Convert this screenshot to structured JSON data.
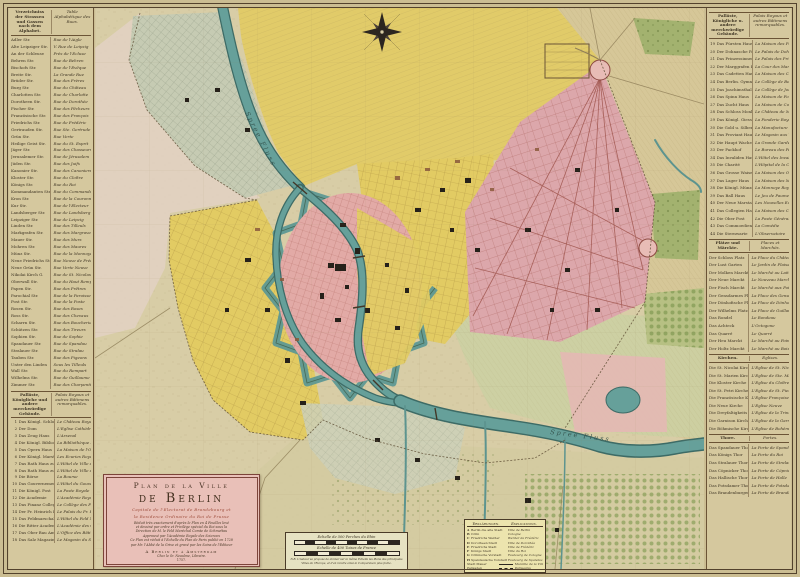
{
  "palette": {
    "paper-edge": "#cbbd92",
    "legend-bg": "#d5c89e",
    "map-bg": "#d8cda6",
    "ink": "#3f3524",
    "river": "#66a09a",
    "river-edge": "#3d6b66",
    "pink-core": "#e2aaa6",
    "pink-grid": "#dca7ab",
    "yellow-district": "#e2cb63",
    "gray-green": "#c6cbb3",
    "pale-green": "#cbd0a2",
    "wood-green": "#a3b26f",
    "cartouche-pink": "#e9c0b8",
    "box-cream": "#e6e2c2",
    "box-yellow": "#ece4ae",
    "street-red": "#9c5048"
  },
  "cartouche": {
    "line1": "Plan de la Ville",
    "line2": "de Berlin",
    "sub1": "Capitale de l'Electorat de Brandebourg et",
    "sub2": "la Residence Ordinaire du Roi de Prusse",
    "body": [
      "Réduit très exactement d'après le Plan en 4 Feuilles levé",
      "et dessiné par ordre et Privilège spécial du Roi sous la",
      "Direction de M. le Feld Maréchal Comte de Schmettau",
      "Approuvé par l'Académie Royale des Sciences",
      "Ce Plan est réduit à l'Echelle du Plan de Paris publié en 1728",
      "par Mr. l'Abbé de la Grive et gravé par les Soins de l'Editeur"
    ],
    "imprint1": "A Berlin et à Amsterdam",
    "imprint2": "Chez le Sr. Neaulme, Libraire.",
    "year": "1757."
  },
  "scalebox": {
    "scale1_label": "Echelle de 500 Perches du Rhin",
    "scale2_label": "Echelle de 400 Toises de France",
    "note": "N.B. L'Auteur se propose de donner sur la même Echelle les Plans des principales Villes de l'Europe, et d'en rendre ainsi la Comparaison plus facile."
  },
  "explanations": {
    "header_de": "Erklärungen.",
    "header_fr": "Explications.",
    "entries": [
      {
        "key": "A",
        "de": "Berlin die alte Stadt",
        "fr": "Ville de Berlin"
      },
      {
        "key": "B",
        "de": "Cölln",
        "fr": "Cologne"
      },
      {
        "key": "C",
        "de": "Friedrichs Werder",
        "fr": "Werder de Frédéric"
      },
      {
        "key": "D",
        "de": "Dorotheen Stadt",
        "fr": "Ville de Dorothée"
      },
      {
        "key": "E",
        "de": "Friedrichs Stadt",
        "fr": "Ville de Frédéric"
      },
      {
        "key": "F",
        "de": "Königs Stadt",
        "fr": "Ville du Roi"
      },
      {
        "key": "G",
        "de": "Cöllnische Vorstadt",
        "fr": "Faubourg de Cologne"
      },
      {
        "key": "H",
        "de": "Spandauische Vorstadt",
        "fr": "Faubourg de Spandau"
      }
    ],
    "samples": [
      {
        "de": "Stadt Mauer",
        "fr": "Muraille de la Ville",
        "style": "solid"
      },
      {
        "de": "Palisaden",
        "fr": "Palissades",
        "style": "dashed"
      }
    ]
  },
  "left_legend": {
    "title_de": "Verzeichniss der Strassen und Gassen nach dem Alphabet.",
    "title_fr": "Table Alphabétique des Rues.",
    "streets": [
      {
        "de": "Adler Str.",
        "fr": "Rue de l'Aigle"
      },
      {
        "de": "Alte Leipziger Str.",
        "fr": "V. Rue de Leipzig"
      },
      {
        "de": "An der Schleuse",
        "fr": "Près de l'Ecluse"
      },
      {
        "de": "Behren Str.",
        "fr": "Rue de Behren"
      },
      {
        "de": "Bischofs Str.",
        "fr": "Rue de l'Evêque"
      },
      {
        "de": "Breite Str.",
        "fr": "La Grande Rue"
      },
      {
        "de": "Brüder Str.",
        "fr": "Rue des Frères"
      },
      {
        "de": "Burg Str.",
        "fr": "Rue du Château"
      },
      {
        "de": "Charlotten Str.",
        "fr": "Rue de Charlotte"
      },
      {
        "de": "Dorotheen Str.",
        "fr": "Rue de Dorothée"
      },
      {
        "de": "Fischer Str.",
        "fr": "Rue des Pêcheurs"
      },
      {
        "de": "Französische Str.",
        "fr": "Rue des François"
      },
      {
        "de": "Friedrichs Str.",
        "fr": "Rue de Frédéric"
      },
      {
        "de": "Gertrauden Str.",
        "fr": "Rue Ste. Gertrude"
      },
      {
        "de": "Grün Str.",
        "fr": "Rue Verte"
      },
      {
        "de": "Heilige Geist Str.",
        "fr": "Rue du St. Esprit"
      },
      {
        "de": "Jäger Str.",
        "fr": "Rue des Chasseurs"
      },
      {
        "de": "Jerusalemer Str.",
        "fr": "Rue de Jérusalem"
      },
      {
        "de": "Jüden Str.",
        "fr": "Rue des Juifs"
      },
      {
        "de": "Kanonier Str.",
        "fr": "Rue des Canoniers"
      },
      {
        "de": "Kloster Str.",
        "fr": "Rue du Cloître"
      },
      {
        "de": "Königs Str.",
        "fr": "Rue du Roi"
      },
      {
        "de": "Kommandanten Str.",
        "fr": "Rue du Commandant"
      },
      {
        "de": "Kron Str.",
        "fr": "Rue de la Couronne"
      },
      {
        "de": "Kur Str.",
        "fr": "Rue de l'Electeur"
      },
      {
        "de": "Landsberger Str.",
        "fr": "Rue de Landsberg"
      },
      {
        "de": "Leipziger Str.",
        "fr": "Rue de Leipzig"
      },
      {
        "de": "Linden Str.",
        "fr": "Rue des Tilleuls"
      },
      {
        "de": "Markgrafen Str.",
        "fr": "Rue des Margraves"
      },
      {
        "de": "Mauer Str.",
        "fr": "Rue des Murs"
      },
      {
        "de": "Mohren Str.",
        "fr": "Rue des Maures"
      },
      {
        "de": "Münz Str.",
        "fr": "Rue de la Monnoye"
      },
      {
        "de": "Neue Friedrichs Str.",
        "fr": "Rue Neuve de Frédéric"
      },
      {
        "de": "Neue Grün Str.",
        "fr": "Rue Verte Neuve"
      },
      {
        "de": "Nikolai Kirch G.",
        "fr": "Rue de St. Nicolas"
      },
      {
        "de": "Oberwall Str.",
        "fr": "Rue du Haut Rempart"
      },
      {
        "de": "Papen Str.",
        "fr": "Rue des Prêtres"
      },
      {
        "de": "Parochial Str.",
        "fr": "Rue de la Paroisse"
      },
      {
        "de": "Post Str.",
        "fr": "Rue de la Poste"
      },
      {
        "de": "Rosen Str.",
        "fr": "Rue des Roses"
      },
      {
        "de": "Ross Str.",
        "fr": "Rue des Chevaux"
      },
      {
        "de": "Scharrn Str.",
        "fr": "Rue des Boucheries"
      },
      {
        "de": "Schützen Str.",
        "fr": "Rue des Tireurs"
      },
      {
        "de": "Sophien Str.",
        "fr": "Rue de Sophie"
      },
      {
        "de": "Spandauer Str.",
        "fr": "Rue de Spandau"
      },
      {
        "de": "Stralauer Str.",
        "fr": "Rue de Stralau"
      },
      {
        "de": "Tauben Str.",
        "fr": "Rue des Pigeons"
      },
      {
        "de": "Unter den Linden",
        "fr": "Sous les Tilleuls"
      },
      {
        "de": "Wall Str.",
        "fr": "Rue du Rempart"
      },
      {
        "de": "Wilhelms Str.",
        "fr": "Rue de Guillaume"
      },
      {
        "de": "Zimmer Str.",
        "fr": "Rue des Charpentiers"
      }
    ],
    "buildings": {
      "title_de": "Palläste, Königliche und andere merckwürdige Gebäude.",
      "title_fr": "Palais Royaux et autres Bâtimens remarquables.",
      "entries": [
        {
          "n": "1",
          "de": "Das Königl. Schloss",
          "fr": "Le Château Royal"
        },
        {
          "n": "2",
          "de": "Der Dom",
          "fr": "L'Eglise Cathédrale"
        },
        {
          "n": "3",
          "de": "Das Zeug Haus",
          "fr": "L'Arsenal"
        },
        {
          "n": "4",
          "de": "Die Königl. Bibliothek",
          "fr": "La Bibliothèque Royale"
        },
        {
          "n": "5",
          "de": "Das Opern Haus",
          "fr": "La Maison de l'Opéra"
        },
        {
          "n": "6",
          "de": "Der Königl. Marstall",
          "fr": "Les Ecuries Royales"
        },
        {
          "n": "7",
          "de": "Das Rath Haus zu Berlin",
          "fr": "L'Hôtel de Ville de Berlin"
        },
        {
          "n": "8",
          "de": "Das Rath Haus zu Cölln",
          "fr": "L'Hôtel de Ville de Cologne"
        },
        {
          "n": "9",
          "de": "Die Börse",
          "fr": "La Bourse"
        },
        {
          "n": "10",
          "de": "Das Gouvernement",
          "fr": "L'Hôtel du Gouvernement"
        },
        {
          "n": "11",
          "de": "Die Königl. Post",
          "fr": "La Poste Royale"
        },
        {
          "n": "12",
          "de": "Die Academie",
          "fr": "L'Académie Royale"
        },
        {
          "n": "13",
          "de": "Das Finanz Collegium",
          "fr": "Le Collège des Finances"
        },
        {
          "n": "14",
          "de": "Der Pr. Heinrich Palast",
          "fr": "Le Palais du Pr. Henri"
        },
        {
          "n": "15",
          "de": "Das Feldmarschall Haus",
          "fr": "L'Hôtel du Feld Maréchal"
        },
        {
          "n": "16",
          "de": "Die Ritter Academie",
          "fr": "L'Académie des Chevaliers"
        },
        {
          "n": "17",
          "de": "Das Ober Bau Amt",
          "fr": "L'Office des Bâtimens"
        },
        {
          "n": "18",
          "de": "Das Salz Magazin",
          "fr": "Le Magasin du Sel"
        }
      ]
    }
  },
  "right_legend": {
    "sections": [
      {
        "title_de": "Palläste, Königliche u. andere merckwürdige Gebäude.",
        "title_fr": "Palais Royaux et autres Bâtimens remarquables.",
        "entries": [
          {
            "n": "19",
            "de": "Das Fürsten Haus",
            "fr": "La Maison des Princes"
          },
          {
            "n": "20",
            "de": "Der Dohnasche Palast",
            "fr": "Le Palais de Dohna"
          },
          {
            "n": "21",
            "de": "Das Prinzessinnen Haus",
            "fr": "Le Palais des Princesses"
          },
          {
            "n": "22",
            "de": "Der Marggrafen Hof",
            "fr": "La Cour des Margraves"
          },
          {
            "n": "23",
            "de": "Das Cadetten Haus",
            "fr": "La Maison des Cadets"
          },
          {
            "n": "24",
            "de": "Das Berlin. Gymnasium",
            "fr": "Le Collège de Berlin"
          },
          {
            "n": "25",
            "de": "Das Joachimsthal. Gymn.",
            "fr": "Le Collège de Joachimsthal"
          },
          {
            "n": "26",
            "de": "Das Spinn Haus",
            "fr": "La Maison de Force"
          },
          {
            "n": "27",
            "de": "Das Zucht Haus",
            "fr": "La Maison de Correction"
          },
          {
            "n": "28",
            "de": "Das Schloss Monbijou",
            "fr": "Le Château de Monbijou"
          },
          {
            "n": "29",
            "de": "Das Königl. Giess Haus",
            "fr": "La Fonderie Royale"
          },
          {
            "n": "30",
            "de": "Die Gold u. Silber Manuf.",
            "fr": "La Manufacture d'Or"
          },
          {
            "n": "31",
            "de": "Das Proviant Haus",
            "fr": "Le Magasin aux Vivres"
          },
          {
            "n": "32",
            "de": "Die Haupt Wache",
            "fr": "La Grande Garde"
          },
          {
            "n": "33",
            "de": "Der Packhof",
            "fr": "Le Bureau des Péages"
          },
          {
            "n": "34",
            "de": "Das Invaliden Haus",
            "fr": "L'Hôtel des Invalides"
          },
          {
            "n": "35",
            "de": "Die Charité",
            "fr": "L'Hôpital de la Charité"
          },
          {
            "n": "36",
            "de": "Das Grosse Waisen Haus",
            "fr": "La Maison des Orphelins"
          },
          {
            "n": "37",
            "de": "Das Lager Haus",
            "fr": "La Maison des Magasins"
          },
          {
            "n": "38",
            "de": "Die Königl. Münze",
            "fr": "La Monnoye Royale"
          },
          {
            "n": "39",
            "de": "Das Ball Haus",
            "fr": "Le Jeu de Paume"
          },
          {
            "n": "40",
            "de": "Der Neue Marstall",
            "fr": "Les Nouvelles Ecuries"
          },
          {
            "n": "41",
            "de": "Das Collegien Haus",
            "fr": "La Maison des Collèges"
          },
          {
            "n": "42",
            "de": "Die Ober Post",
            "fr": "La Poste Générale"
          },
          {
            "n": "43",
            "de": "Das Commoedien Haus",
            "fr": "La Comédie"
          },
          {
            "n": "44",
            "de": "Die Sternwarte",
            "fr": "L'Observatoire"
          }
        ]
      },
      {
        "title_de": "Plätze und Märckte.",
        "title_fr": "Places et Marchés.",
        "entries": [
          {
            "de": "Der Schloss Platz",
            "fr": "La Place du Château"
          },
          {
            "de": "Der Lust Garten",
            "fr": "Le Jardin de Plaisance"
          },
          {
            "de": "Der Molken Marckt",
            "fr": "Le Marché au Lait"
          },
          {
            "de": "Der Neue Marckt",
            "fr": "Le Nouveau Marché"
          },
          {
            "de": "Der Fisch Marckt",
            "fr": "Le Marché aux Poissons"
          },
          {
            "de": "Der Gensdarmes Platz",
            "fr": "La Place des Gensdarmes"
          },
          {
            "de": "Der Dönhofische Platz",
            "fr": "La Place de Dönhof"
          },
          {
            "de": "Der Wilhelms Platz",
            "fr": "La Place de Guillaume"
          },
          {
            "de": "Das Rondel",
            "fr": "Le Rondeau"
          },
          {
            "de": "Das Achteck",
            "fr": "L'Octogone"
          },
          {
            "de": "Das Quarré",
            "fr": "Le Quarré"
          },
          {
            "de": "Der Heu Marckt",
            "fr": "Le Marché au Foin"
          },
          {
            "de": "Der Holtz Marckt",
            "fr": "Le Marché au Bois"
          }
        ]
      },
      {
        "title_de": "Kirchen.",
        "title_fr": "Eglises.",
        "entries": [
          {
            "de": "Die St. Nicolai Kirche",
            "fr": "L'Eglise de St. Nicolas"
          },
          {
            "de": "Die St. Marien Kirche",
            "fr": "L'Eglise de Ste. Marie"
          },
          {
            "de": "Die Kloster Kirche",
            "fr": "L'Eglise du Cloître"
          },
          {
            "de": "Die St. Petri Kirche",
            "fr": "L'Eglise de St. Pierre"
          },
          {
            "de": "Die Französische Kirche",
            "fr": "L'Eglise Françoise"
          },
          {
            "de": "Die Neue Kirche",
            "fr": "L'Eglise Neuve"
          },
          {
            "de": "Die Dreyfaltigkeits K.",
            "fr": "L'Eglise de la Trinité"
          },
          {
            "de": "Die Garnison Kirche",
            "fr": "L'Eglise de la Garnison"
          },
          {
            "de": "Die Böhmische Kirche",
            "fr": "L'Eglise de Bohème"
          }
        ]
      },
      {
        "title_de": "Thore.",
        "title_fr": "Portes.",
        "entries": [
          {
            "de": "Das Spandauer Thor",
            "fr": "La Porte de Spandau"
          },
          {
            "de": "Das Königs Thor",
            "fr": "La Porte du Roi"
          },
          {
            "de": "Das Stralauer Thor",
            "fr": "La Porte de Stralau"
          },
          {
            "de": "Das Cöpnicker Thor",
            "fr": "La Porte de Cöpnick"
          },
          {
            "de": "Das Hallische Thor",
            "fr": "La Porte de Halle"
          },
          {
            "de": "Das Potsdamer Thor",
            "fr": "La Porte de Potsdam"
          },
          {
            "de": "Das Brandenburger Thor",
            "fr": "La Porte de Brandebourg"
          }
        ]
      }
    ]
  },
  "map": {
    "river_label_top": "Spree Fluss",
    "river_label_low": "Spree Fluss"
  }
}
